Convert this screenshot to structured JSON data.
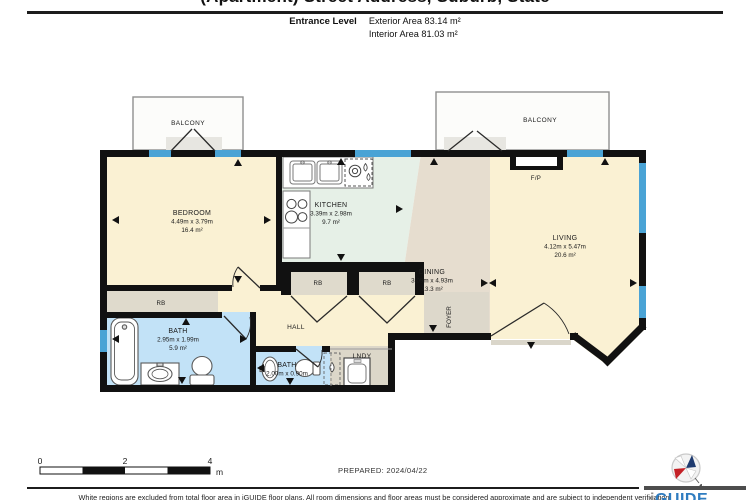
{
  "title_clipped": "(Apartment) Street Address, Suburb, State",
  "header": {
    "level": "Entrance Level",
    "exterior": "Exterior Area 83.14 m²",
    "interior": "Interior Area 81.03 m²"
  },
  "rooms": {
    "bedroom": {
      "name": "BEDROOM",
      "dims": "4.49m x 3.79m",
      "area": "16.4 m²"
    },
    "kitchen": {
      "name": "KITCHEN",
      "dims": "3.39m x 2.98m",
      "area": "9.7 m²"
    },
    "living": {
      "name": "LIVING",
      "dims": "4.12m x 5.47m",
      "area": "20.6 m²"
    },
    "dining": {
      "name": "DINING",
      "dims": "3.09m x 4.93m",
      "area": "13.3 m²"
    },
    "bath_main": {
      "name": "BATH",
      "dims": "2.95m x 1.99m",
      "area": "5.9 m²"
    },
    "bath_small": {
      "name": "BATH",
      "dims": "2.00m x 0.90m"
    },
    "hall": {
      "name": "HALL"
    },
    "foyer": {
      "name": "FOYER"
    },
    "laundry": {
      "name": "LNDY"
    },
    "balcony_left": {
      "name": "BALCONY"
    },
    "balcony_right": {
      "name": "BALCONY"
    },
    "fireplace": {
      "name": "F/P"
    },
    "robe": {
      "name": "RB"
    }
  },
  "scale_bar": {
    "tick0": "0",
    "tick2": "2",
    "tick4": "4",
    "unit": "m"
  },
  "footer": {
    "prepared": "PREPARED: 2024/04/22",
    "disclaimer": "White regions are excluded from total floor area in iGUIDE floor plans. All room dimensions and floor areas must be considered approximate and are subject to independent verification."
  },
  "brand": {
    "name_i": "i",
    "name_guide": "GUIDE",
    "compass_n": "N"
  },
  "colors": {
    "wall": "#111111",
    "window": "#4aa3d5",
    "room_cream": "#faf1d3",
    "room_mint": "#e6f0e7",
    "room_tan": "#e6ddcf",
    "room_blue": "#c2e2f7",
    "closet_gray": "#dfdacc",
    "brand_blue": "#2f7cc0",
    "compass_red": "#c42127",
    "compass_navy": "#1f3b70"
  }
}
